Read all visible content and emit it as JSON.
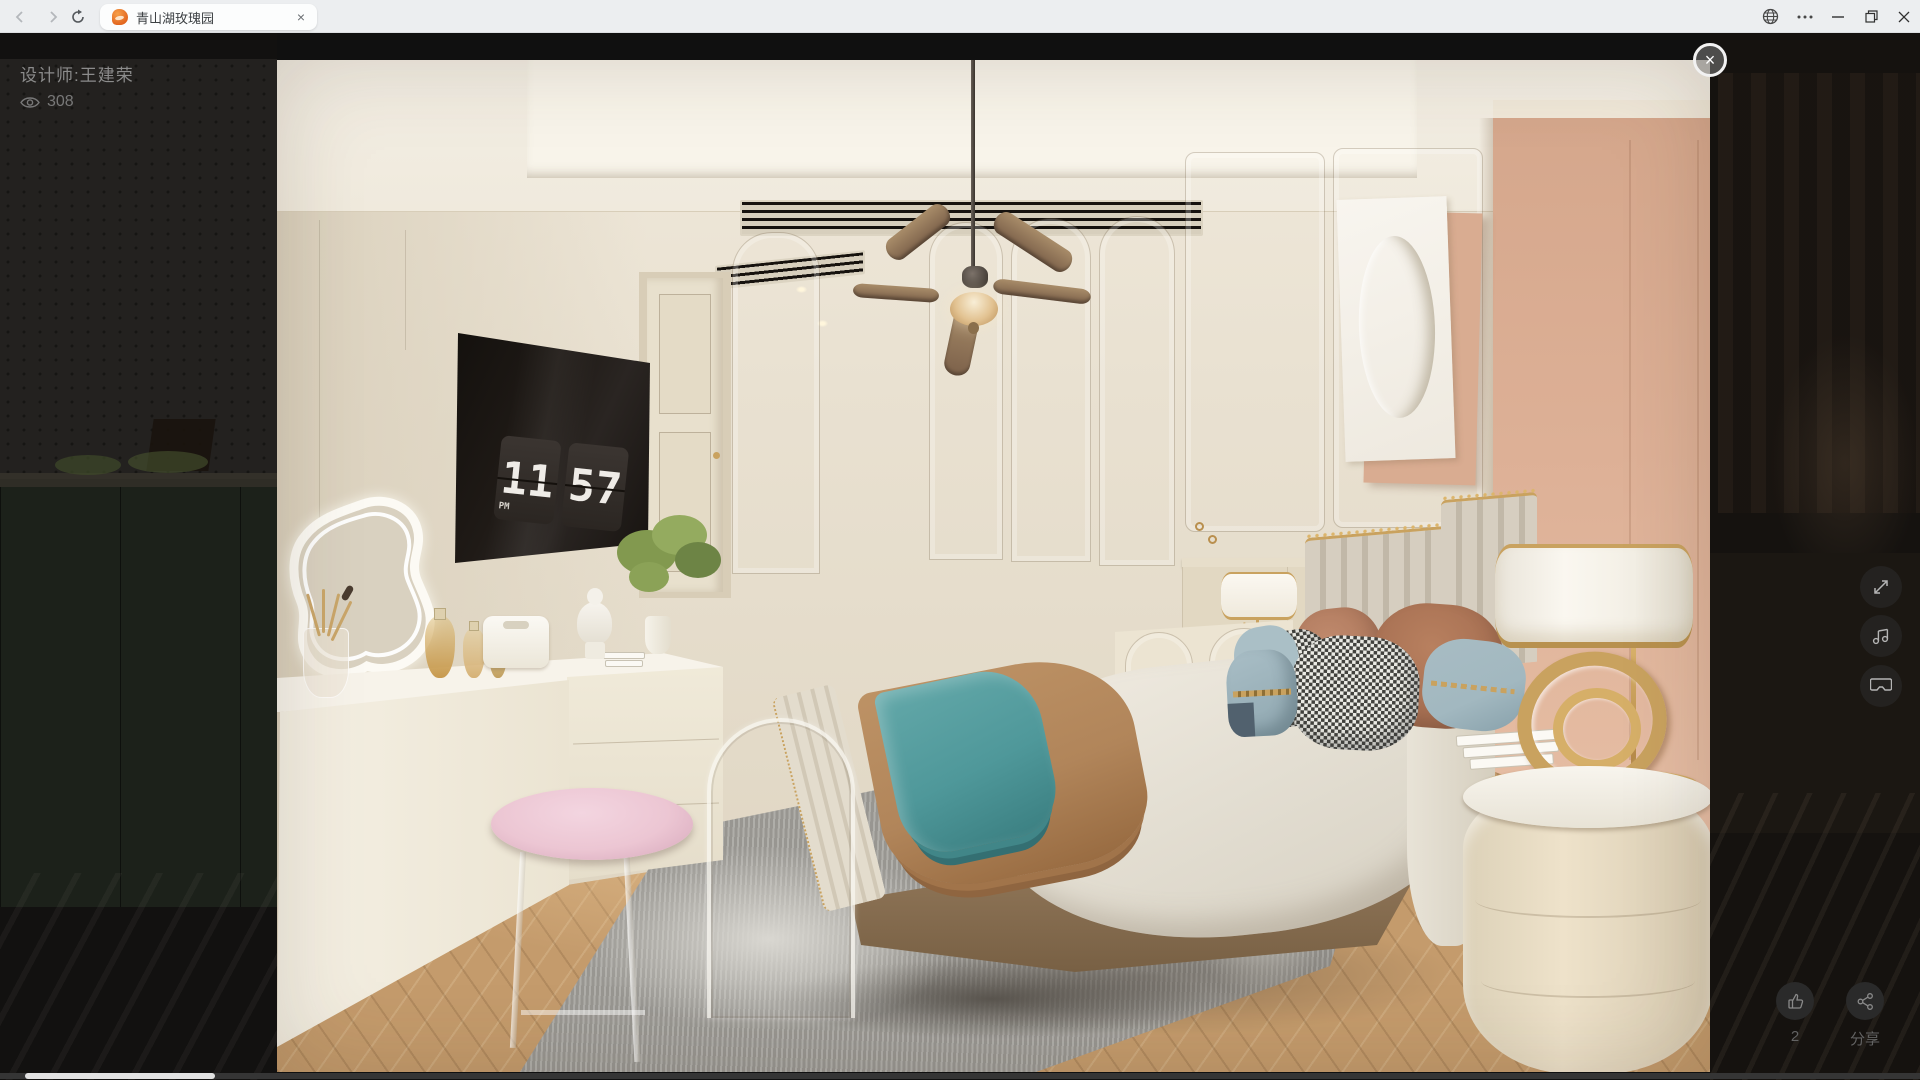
{
  "browser": {
    "tab_title": "青山湖玫瑰园"
  },
  "overlay": {
    "designer": "设计师:王建荣",
    "views": "308",
    "like_count": "2",
    "share_label": "分享",
    "close_glyph": "×",
    "tab_close_glyph": "×"
  },
  "scene": {
    "clock": {
      "hours": "11",
      "minutes": "57",
      "meridiem": "PM"
    }
  },
  "icons": [
    "back",
    "forward",
    "refresh",
    "tab-favicon",
    "tab-close",
    "globe",
    "more-menu",
    "minimize",
    "restore",
    "close",
    "eye",
    "fullscreen",
    "music",
    "vr",
    "thumbs-up",
    "share"
  ],
  "theme": {
    "titlebar-bg": "#eceef0",
    "tab-bg": "#fcfdfd",
    "page-bg": "#101010",
    "wall-cream": "#e9e1d1",
    "ceiling": "#f3eee4",
    "accent-peach": "#ddb096",
    "floor-wood": "#c49b6c",
    "rug-gray": "#a09e99",
    "teal": "#4f989a",
    "camel": "#b1855a",
    "terracotta": "#b07a5e",
    "dusty-blue": "#a2b8c0",
    "gold": "#c9a25f",
    "pink-cushion": "#ecc6d3"
  }
}
